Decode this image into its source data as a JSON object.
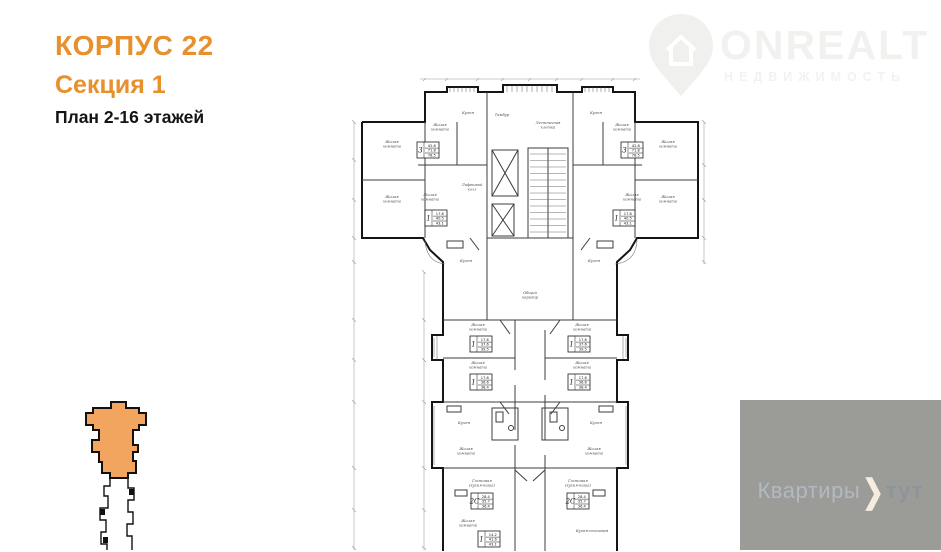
{
  "header": {
    "building": "КОРПУС 22",
    "section": "Секция 1",
    "plan_label": "План 2-16 этажей",
    "accent_color": "#e8902c",
    "text_color": "#141414"
  },
  "brand": {
    "name": "ONREALT",
    "subtitle": "НЕДВИЖИМОСТЬ",
    "watermark_color": "#f1f1ef"
  },
  "footer_watermark": {
    "prefix": "Квартиры",
    "chevron": "❯",
    "suffix": "тут",
    "band_color": "#9b9b97",
    "prefix_color": "#b2b9c1",
    "suffix_color": "#8e949b",
    "chevron_color": "#f5edde"
  },
  "minimap": {
    "highlight_fill": "#f2a55f",
    "outline_color": "#111111"
  },
  "plan": {
    "wall_color": "#151515",
    "room_labels": [
      {
        "t": "Жилая комната",
        "x": 392,
        "y": 143
      },
      {
        "t": "Жилая комната",
        "x": 440,
        "y": 126
      },
      {
        "t": "Кухня",
        "x": 468,
        "y": 114
      },
      {
        "t": "Тамбур",
        "x": 502,
        "y": 116
      },
      {
        "t": "Лестничная клетка",
        "x": 548,
        "y": 124
      },
      {
        "t": "Кухня",
        "x": 596,
        "y": 114
      },
      {
        "t": "Жилая комната",
        "x": 622,
        "y": 126
      },
      {
        "t": "Жилая комната",
        "x": 668,
        "y": 143
      },
      {
        "t": "Лифтовой холл",
        "x": 472,
        "y": 186
      },
      {
        "t": "Жилая комната",
        "x": 392,
        "y": 198
      },
      {
        "t": "Жилая комната",
        "x": 430,
        "y": 196
      },
      {
        "t": "Жилая комната",
        "x": 632,
        "y": 196
      },
      {
        "t": "Жилая комната",
        "x": 668,
        "y": 198
      },
      {
        "t": "Кухня",
        "x": 466,
        "y": 262
      },
      {
        "t": "Кухня",
        "x": 594,
        "y": 262
      },
      {
        "t": "Общий коридор",
        "x": 530,
        "y": 294
      },
      {
        "t": "Жилая комната",
        "x": 478,
        "y": 326
      },
      {
        "t": "Жилая комната",
        "x": 582,
        "y": 326
      },
      {
        "t": "Жилая комната",
        "x": 478,
        "y": 364
      },
      {
        "t": "Жилая комната",
        "x": 582,
        "y": 364
      },
      {
        "t": "Кухня",
        "x": 464,
        "y": 424
      },
      {
        "t": "Кухня",
        "x": 596,
        "y": 424
      },
      {
        "t": "Жилая комната",
        "x": 466,
        "y": 450
      },
      {
        "t": "Жилая комната",
        "x": 594,
        "y": 450
      },
      {
        "t": "Гостиная (кухня-ниша)",
        "x": 482,
        "y": 482
      },
      {
        "t": "Гостиная (кухня-ниша)",
        "x": 578,
        "y": 482
      },
      {
        "t": "Жилая комната",
        "x": 468,
        "y": 522
      },
      {
        "t": "Кухня-столовая",
        "x": 592,
        "y": 532
      }
    ],
    "stamps": [
      {
        "num": "3",
        "a": "42.8",
        "b": "71.8",
        "c": "78.5",
        "x": 428,
        "y": 150
      },
      {
        "num": "3",
        "a": "42.8",
        "b": "71.8",
        "c": "78.5",
        "x": 632,
        "y": 150
      },
      {
        "num": "1",
        "a": "17.6",
        "b": "40.5",
        "c": "43.1",
        "x": 436,
        "y": 218
      },
      {
        "num": "1",
        "a": "17.6",
        "b": "40.5",
        "c": "43.1",
        "x": 624,
        "y": 218
      },
      {
        "num": "1",
        "a": "17.6",
        "b": "37.6",
        "c": "39.5",
        "x": 481,
        "y": 344
      },
      {
        "num": "1",
        "a": "17.6",
        "b": "37.6",
        "c": "39.5",
        "x": 579,
        "y": 344
      },
      {
        "num": "1",
        "a": "17.6",
        "b": "36.6",
        "c": "38.4",
        "x": 481,
        "y": 382
      },
      {
        "num": "1",
        "a": "17.6",
        "b": "36.6",
        "c": "38.4",
        "x": 579,
        "y": 382
      },
      {
        "num": "2С",
        "a": "28.4",
        "b": "35.7",
        "c": "36.4",
        "x": 482,
        "y": 501
      },
      {
        "num": "2С",
        "a": "28.4",
        "b": "35.7",
        "c": "36.4",
        "x": 578,
        "y": 501
      },
      {
        "num": "1",
        "a": "14.2",
        "b": "41.6",
        "c": "43.1",
        "x": 489,
        "y": 539
      }
    ]
  }
}
